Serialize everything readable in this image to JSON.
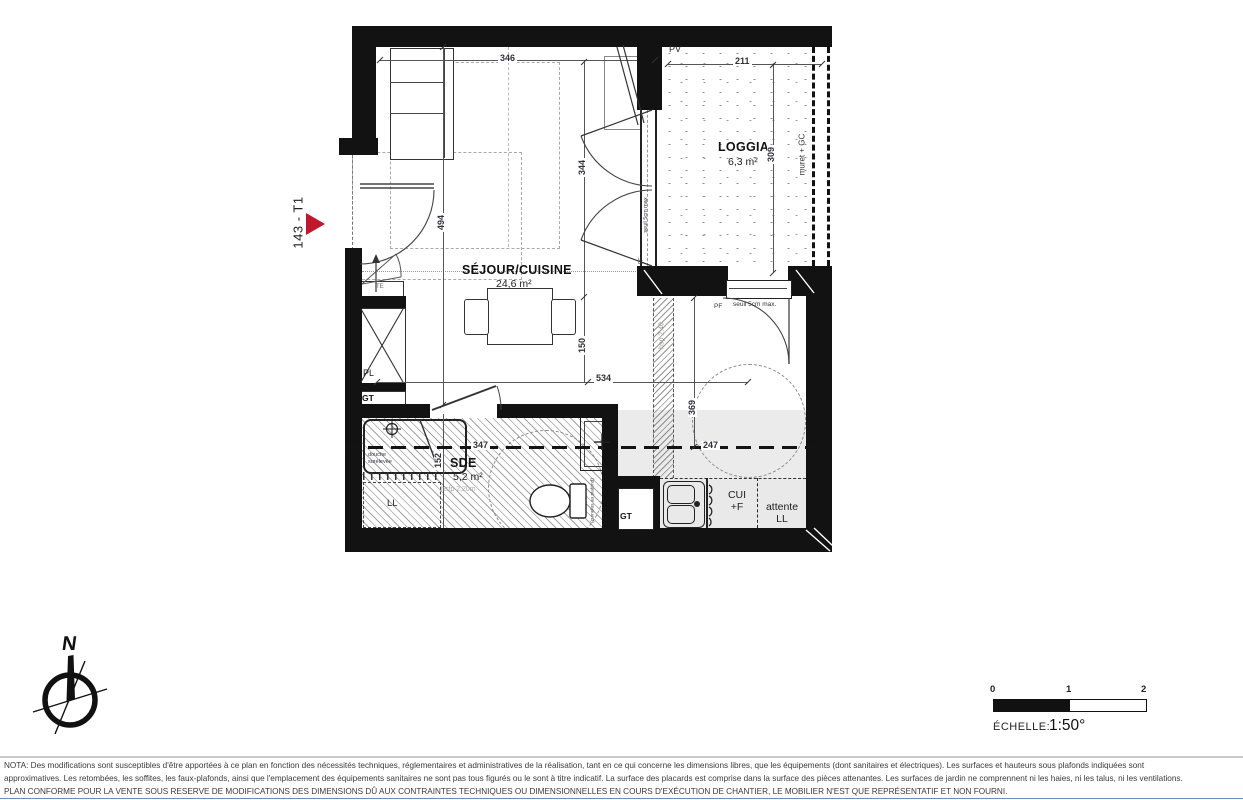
{
  "plan_id": "143 - T1",
  "rooms": {
    "sejour": {
      "name": "SÉJOUR/CUISINE",
      "area": "24,6 m²"
    },
    "loggia": {
      "name": "LOGGIA",
      "area": "6,3 m²"
    },
    "sde": {
      "name": "SDE",
      "area": "5,2 m²"
    }
  },
  "dims": {
    "d346": "346",
    "d211": "211",
    "d494": "494",
    "d344": "344",
    "d309": "309",
    "d150": "150",
    "d534": "534",
    "d347": "347",
    "d152": "152",
    "d369": "369",
    "d247": "247"
  },
  "labels": {
    "pv": "PV",
    "muret": "muret + GC",
    "seuil_window": "seuil 5cm max",
    "pf_window": "PF",
    "pf_door": "PF",
    "seuil_door": "seuil 5cm max.",
    "te": "TE",
    "pl": "PL",
    "gt_entry": "GT",
    "gt_duct": "GT",
    "ll": "LL",
    "douche_l1": "douche",
    "douche_l2": "surélevée",
    "hsfp": "hsfp 2,20m",
    "hsp": "hsp 2,40",
    "cumulus": "(cumulus au plafond)",
    "cui_l1": "CUI",
    "cui_l2": "+F",
    "attente_l1": "attente",
    "attente_l2": "LL"
  },
  "compass": {
    "north": "N"
  },
  "scale_bar": {
    "tick0": "0",
    "tick1": "1",
    "tick2": "2",
    "caption": "ÉCHELLE:",
    "ratio": "1:50°"
  },
  "footer": {
    "line1": "NOTA: Des modifications sont susceptibles d'être apportées à ce plan en fonction des nécessités techniques, réglementaires et administratives de la réalisation, tant en ce qui concerne les dimensions libres, que les équipements (dont sanitaires et électriques). Les surfaces et hauteurs sous plafonds indiquées sont",
    "line2": "approximatives. Les retombées, les soffites, les faux-plafonds, ainsi que l'emplacement des équipements sanitaires ne sont pas tous figurés ou le sont à titre indicatif. La surface des placards est comprise dans la surface des pièces attenantes. Les surfaces de jardin ne comprennent ni les haies, ni les talus, ni les ventilations.",
    "line3": "PLAN CONFORME POUR LA VENTE SOUS RESERVE DE MODIFICATIONS DES DIMENSIONS DÛ AUX CONTRAINTES TECHNIQUES OU DIMENSIONNELLES EN COURS D'EXÉCUTION DE CHANTIER, LE MOBILIER N'EST QUE REPRÉSENTATIF ET NON FOURNI."
  },
  "colors": {
    "accent_red": "#c0172c",
    "wall": "#121212",
    "shade": "#ebebeb"
  }
}
